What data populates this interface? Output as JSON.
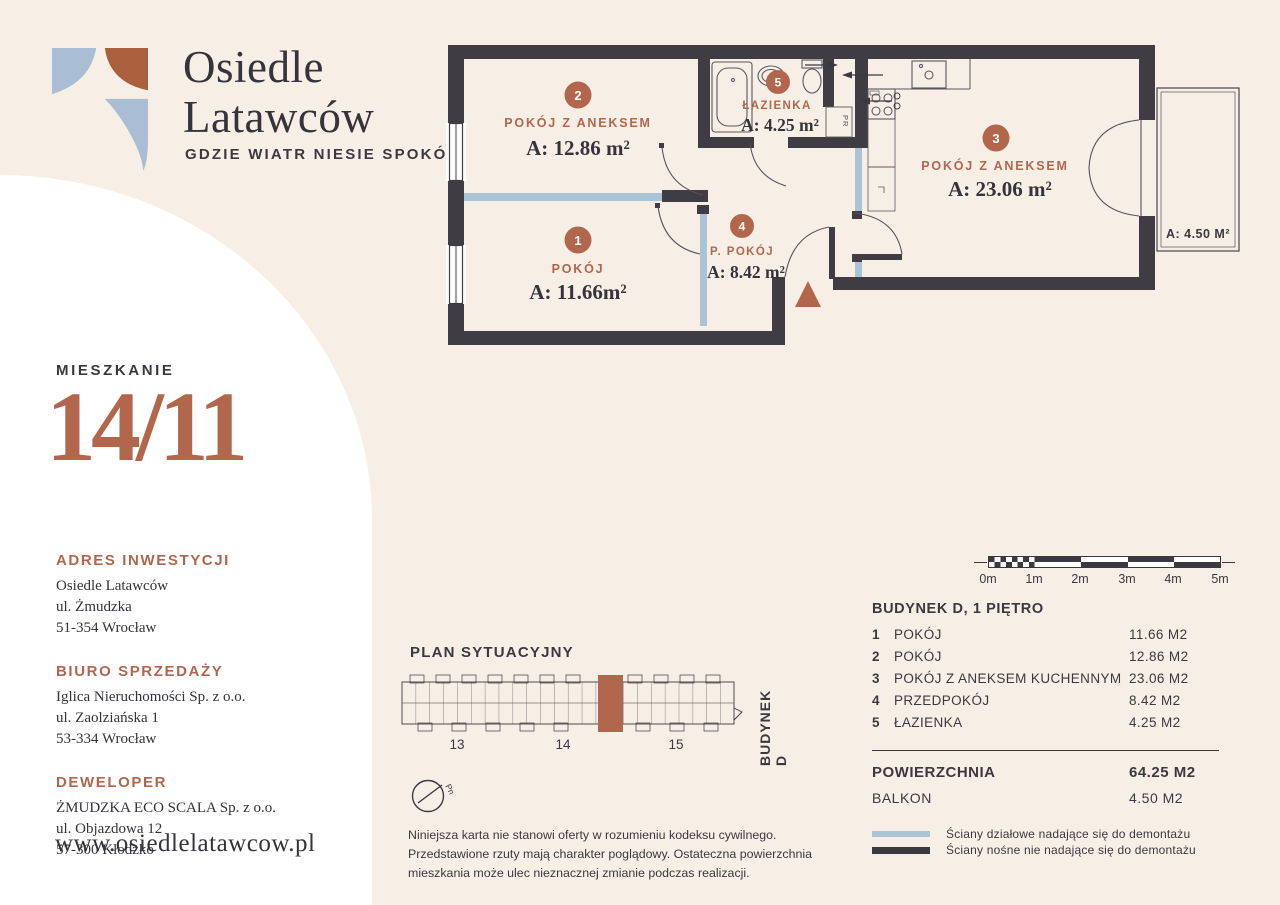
{
  "colors": {
    "cream": "#f7eee6",
    "white": "#ffffff",
    "dark": "#3b3840",
    "wall": "#3f3c44",
    "terracotta": "#b2674c",
    "light_blue": "#a9c3d7",
    "logo_blue": "#a9bed4",
    "logo_rust": "#ab5f3d"
  },
  "brand": {
    "name_line1": "Osiedle",
    "name_line2": "Latawców",
    "tagline": "GDZIE WIATR NIESIE SPOKÓJ"
  },
  "apartment": {
    "label": "MIESZKANIE",
    "number": "14/11"
  },
  "sidebar": {
    "sections": [
      {
        "heading": "ADRES INWESTYCJI",
        "lines": [
          "Osiedle Latawców",
          "ul. Żmudzka",
          "51-354 Wrocław"
        ]
      },
      {
        "heading": "BIURO SPRZEDAŻY",
        "lines": [
          "Iglica Nieruchomości Sp. z o.o.",
          "ul. Zaolziańska 1",
          "53-334 Wrocław"
        ]
      },
      {
        "heading": "DEWELOPER",
        "lines": [
          "ŻMUDZKA ECO SCALA Sp. z o.o.",
          "ul. Objazdowa 12",
          "57-300 Kłodzko"
        ]
      }
    ],
    "website": "www.osiedlelatawcow.pl"
  },
  "floor_plan": {
    "rooms": [
      {
        "id": "1",
        "name": "POKÓJ",
        "area": "A: 11.66m²"
      },
      {
        "id": "2",
        "name": "POKÓJ Z ANEKSEM",
        "area": "A: 12.86 m²"
      },
      {
        "id": "3",
        "name": "POKÓJ Z ANEKSEM",
        "area": "A: 23.06 m²"
      },
      {
        "id": "4",
        "name": "P. POKÓJ",
        "area": "A: 8.42 m²"
      },
      {
        "id": "5",
        "name": "ŁAZIENKA",
        "area": "A: 4.25 m²"
      }
    ],
    "balcony_label": "A: 4.50 M²",
    "closet_label": "PR"
  },
  "site_plan": {
    "title": "PLAN SYTUACYJNY",
    "building_label": "BUDYNEK D",
    "unit_numbers": [
      "13",
      "14",
      "15"
    ],
    "compass_label": "Pn"
  },
  "scale_bar": {
    "ticks": [
      "0m",
      "1m",
      "2m",
      "3m",
      "4m",
      "5m"
    ]
  },
  "summary": {
    "header": "BUDYNEK D, 1 PIĘTRO",
    "rows": [
      {
        "num": "1",
        "name": "POKÓJ",
        "area": "11.66 M2"
      },
      {
        "num": "2",
        "name": "POKÓJ",
        "area": "12.86 M2"
      },
      {
        "num": "3",
        "name": "POKÓJ Z ANEKSEM KUCHENNYM",
        "area": "23.06 M2"
      },
      {
        "num": "4",
        "name": "PRZEDPOKÓJ",
        "area": "8.42 M2"
      },
      {
        "num": "5",
        "name": "ŁAZIENKA",
        "area": "4.25 M2"
      }
    ],
    "total": {
      "name": "POWIERZCHNIA",
      "area": "64.25 M2"
    },
    "balcony": {
      "name": "BALKON",
      "area": "4.50 M2"
    },
    "legend": [
      {
        "label": "Ściany działowe nadające się do demontażu"
      },
      {
        "label": "Ściany nośne nie nadające się do demontażu"
      }
    ]
  },
  "disclaimer": {
    "line1": "Niniejsza karta nie stanowi oferty w rozumieniu kodeksu cywilnego.",
    "line2": "Przedstawione rzuty mają charakter poglądowy. Ostateczna powierzchnia",
    "line3": "mieszkania może ulec nieznacznej zmianie podczas realizacji."
  }
}
